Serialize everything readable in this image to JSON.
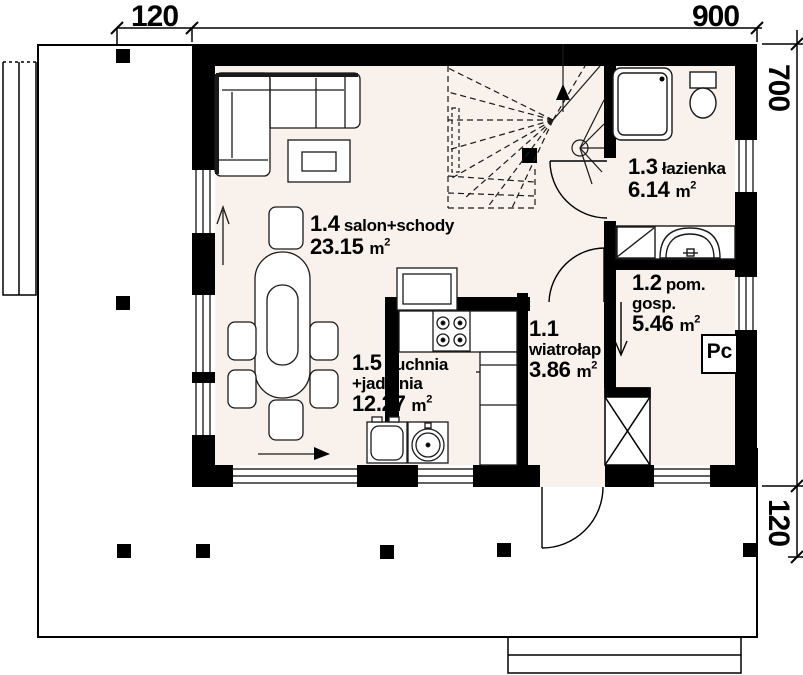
{
  "dimensions": {
    "top_porch_width": "120",
    "top_house_width": "900",
    "right_house_depth": "700",
    "right_terrace_depth": "120"
  },
  "unit": {
    "m": "m",
    "sup": "2"
  },
  "rooms": {
    "salon": {
      "no": "1.4",
      "name": "salon+schody",
      "area": "23.15"
    },
    "kitchen": {
      "no": "1.5",
      "name": "kuchnia",
      "name2": "+jadalnia",
      "area": "12.27"
    },
    "vestibule": {
      "no": "1.1",
      "name": "wiatrołap",
      "area": "3.86"
    },
    "bathroom": {
      "no": "1.3",
      "name": "łazienka",
      "area": "6.14"
    },
    "utility": {
      "no": "1.2",
      "name": "pom.",
      "name2": "gosp.",
      "area": "5.46"
    }
  },
  "boiler": {
    "label": "Pc"
  },
  "colors": {
    "wall": "#000000",
    "floor": "#f8f1ec",
    "background": "#ffffff",
    "line": "#1a1a1a"
  }
}
